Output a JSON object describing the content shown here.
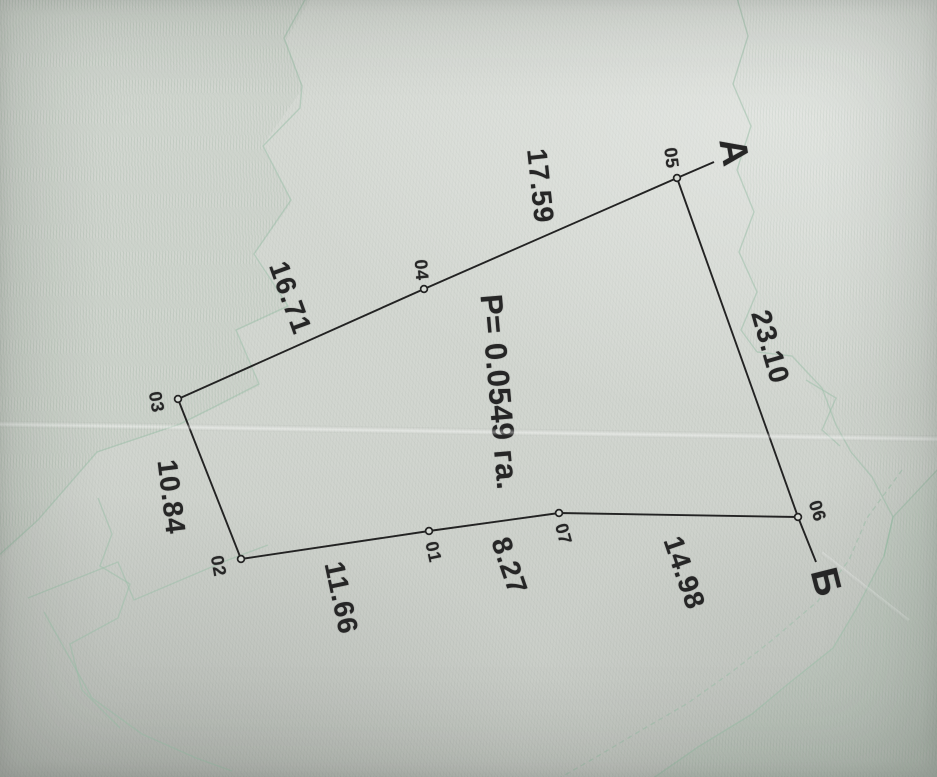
{
  "plan": {
    "area_label": {
      "text": "P= 0.0549 га.",
      "x": 499,
      "y": 392,
      "rot": 85
    },
    "outline_order": [
      "01",
      "02",
      "03",
      "04",
      "05",
      "06",
      "07"
    ],
    "points": [
      {
        "label": "01",
        "x": 429,
        "y": 531,
        "lx": 433,
        "ly": 552,
        "rot": 78
      },
      {
        "label": "02",
        "x": 241,
        "y": 559,
        "lx": 218,
        "ly": 566,
        "rot": 80
      },
      {
        "label": "03",
        "x": 178,
        "y": 399,
        "lx": 156,
        "ly": 402,
        "rot": 80
      },
      {
        "label": "04",
        "x": 424,
        "y": 289,
        "lx": 421,
        "ly": 270,
        "rot": 85
      },
      {
        "label": "05",
        "x": 677,
        "y": 178,
        "lx": 671,
        "ly": 158,
        "rot": 83
      },
      {
        "label": "06",
        "x": 798,
        "y": 517,
        "lx": 817,
        "ly": 511,
        "rot": 72
      },
      {
        "label": "07",
        "x": 559,
        "y": 513,
        "lx": 563,
        "ly": 534,
        "rot": 75
      }
    ],
    "sides": [
      {
        "from": "01",
        "to": "02",
        "length": "11.66",
        "lx": 341,
        "ly": 598,
        "rot": 78
      },
      {
        "from": "02",
        "to": "03",
        "length": "10.84",
        "lx": 171,
        "ly": 497,
        "rot": 83
      },
      {
        "from": "03",
        "to": "04",
        "length": "16.71",
        "lx": 290,
        "ly": 298,
        "rot": 70
      },
      {
        "from": "04",
        "to": "05",
        "length": "17.59",
        "lx": 540,
        "ly": 186,
        "rot": 84
      },
      {
        "from": "05",
        "to": "06",
        "length": "23.10",
        "lx": 770,
        "ly": 347,
        "rot": 74
      },
      {
        "from": "06",
        "to": "07",
        "length": "14.98",
        "lx": 684,
        "ly": 573,
        "rot": 71
      },
      {
        "from": "07",
        "to": "01",
        "length": "8.27",
        "lx": 509,
        "ly": 566,
        "rot": 71
      }
    ],
    "corner_marks": [
      {
        "name": "А",
        "x": 733,
        "y": 152,
        "rot": 80,
        "tick_from": "05",
        "tick_x": 714,
        "tick_y": 162
      },
      {
        "name": "Б",
        "x": 825,
        "y": 582,
        "rot": 76,
        "tick_from": "06",
        "tick_x": 816,
        "tick_y": 562
      }
    ],
    "colors": {
      "ink": "#232323",
      "paper": "#d6dad4",
      "green_pattern": "#9cc0aa"
    }
  }
}
